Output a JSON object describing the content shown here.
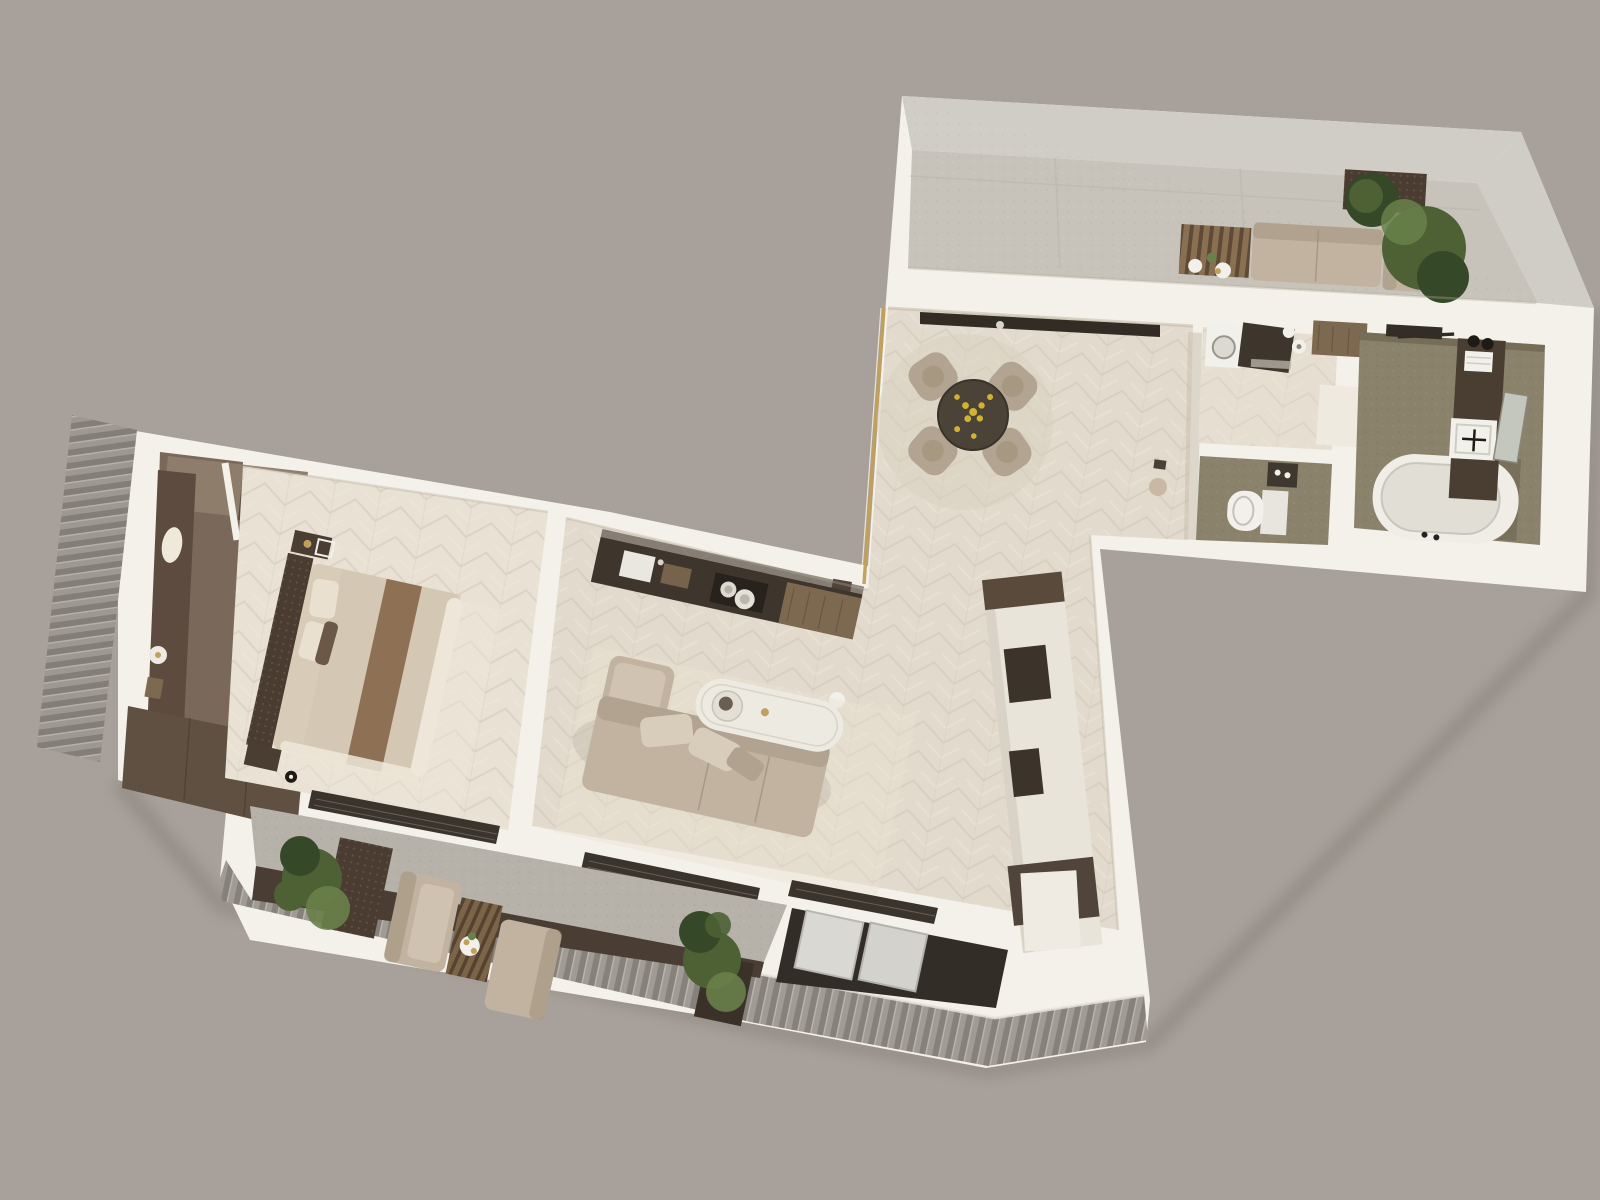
{
  "scene": {
    "kind": "3d-floor-plan-render",
    "view": "top-down",
    "style": "photoreal beige interior visualization",
    "rooms": [
      {
        "id": "terrace",
        "floor": "light concrete slabs"
      },
      {
        "id": "dining-area",
        "floor": "cream chevron parquet"
      },
      {
        "id": "kitchen",
        "floor": "cream chevron parquet"
      },
      {
        "id": "living-room",
        "floor": "cream chevron parquet"
      },
      {
        "id": "corridor",
        "floor": "cream chevron parquet"
      },
      {
        "id": "bedroom",
        "floor": "cream chevron parquet"
      },
      {
        "id": "entry-hall",
        "floor": "dark wood"
      },
      {
        "id": "laundry-room",
        "floor": "cream chevron parquet"
      },
      {
        "id": "wc",
        "floor": "olive textured stone"
      },
      {
        "id": "bathroom",
        "floor": "olive textured stone"
      },
      {
        "id": "balcony",
        "floor": "grey stone with wood deck edge"
      },
      {
        "id": "loggia-niche",
        "floor": "dark recess with glass panels"
      }
    ],
    "furniture": {
      "terrace": [
        "outdoor-sofa",
        "slatted-wood-table",
        "side-plates",
        "planter-palm",
        "planter-bush"
      ],
      "dining-area": [
        "round-dining-table",
        "dining-chair x4",
        "fruit-bowl",
        "round-rug",
        "sideboard",
        "coat-corner"
      ],
      "kitchen": [
        "counter-run",
        "sink",
        "hob-pots",
        "wood-worktop",
        "console"
      ],
      "living-room": [
        "l-shaped-sofa",
        "toss-cushions",
        "oval-coffee-table",
        "tall-wardrobe-unit",
        "area-rug"
      ],
      "bedroom": [
        "double-bed",
        "studded-headboard",
        "bed-runner",
        "pillows",
        "nightstand x2",
        "wall-lamp",
        "built-in-closet"
      ],
      "entry-hall": [
        "wardrobe-run",
        "hanging-robe",
        "round-tray",
        "bench-cabinets"
      ],
      "laundry-room": [
        "washing-machine",
        "dark-counter",
        "storage-jars",
        "wall-cabinet",
        "open-door"
      ],
      "wc": [
        "toilet",
        "niche-shelf",
        "cistern-panel"
      ],
      "bathroom": [
        "bathtub",
        "vanity-column",
        "square-sink",
        "mirror",
        "towels",
        "towel-bar"
      ],
      "balcony": [
        "lounge-sofa x2",
        "slat-deck-mat",
        "drinks-table",
        "planter x2"
      ]
    }
  },
  "palette": {
    "bg": "#a8a19b",
    "wallTop": "#f3f1ea",
    "wallShadeWarm": "#cbbfae",
    "terraceStone": "#d0cdc6",
    "terraceFloor": "#c7c3bb",
    "floorOpen": "#e2dacc",
    "floorBedroom": "#e8e1d4",
    "floorLaundry": "#e6ded1",
    "olive": "#8b826c",
    "oliveDark": "#6f6753",
    "entryFloor": "#7a685a",
    "entryTan": "#8f7d6b",
    "wardrobe": "#5c4b3e",
    "counterDark": "#3e362d",
    "woodMid": "#7d6850",
    "tableWood": "#4b4238",
    "chairBeige": "#b2a491",
    "sofaBeige": "#c2b3a1",
    "sofaShadow": "#a2937f",
    "cushionLight": "#d8ccba",
    "bedDuvet": "#d8cbb8",
    "bedRunner": "#8e7154",
    "bedTrim": "#eee7d9",
    "headboard": "#55463a",
    "cabinetCream": "#e9e4da",
    "fixtureWhite": "#f2f0ea",
    "tubInner": "#e0ded5",
    "balconyStone": "#b6b2aa",
    "deckDark": "#4a3e34",
    "ribBase": "#a09b94",
    "ribStripe": "#86817a",
    "glassDark": "#3a342d",
    "glassLine": "#6f6a60",
    "panelLight": "#d9d8d3",
    "plantGreen": "#4d6134",
    "plantDark": "#354827",
    "plantLight": "#69814a",
    "goldAccent": "#c2a05c",
    "fruitYellow": "#d2b232",
    "shadow": "#7e7870"
  }
}
